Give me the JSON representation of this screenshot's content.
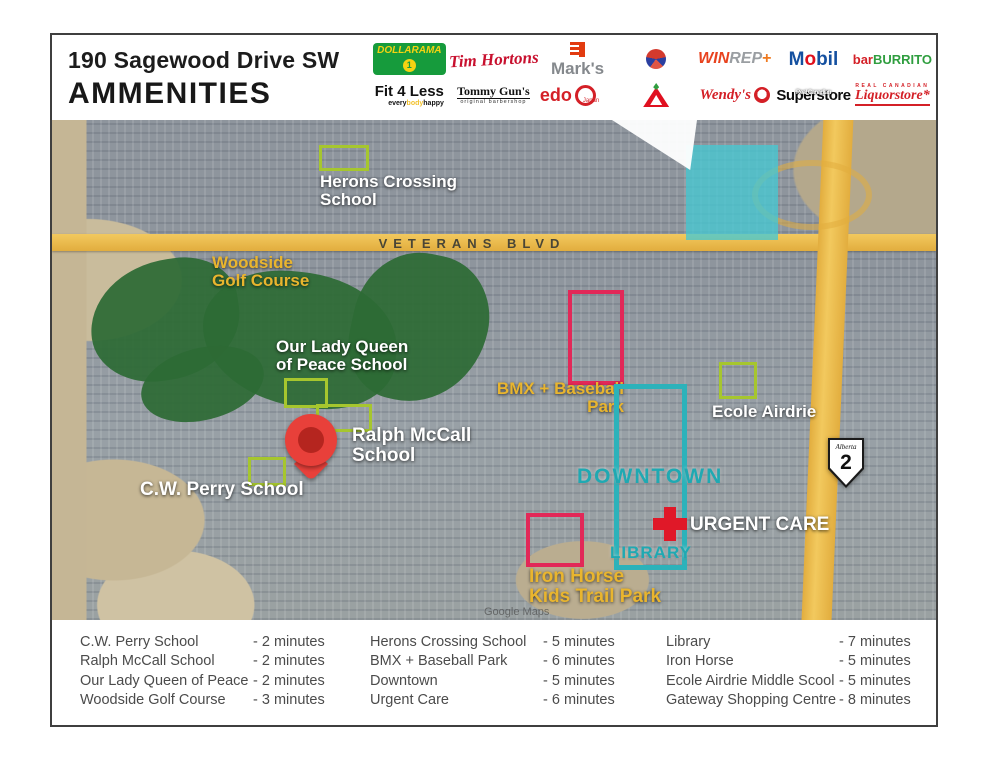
{
  "header": {
    "address": "190 Sagewood Drive SW",
    "title": "AMMENITIES"
  },
  "logos": {
    "dollarama": {
      "text": "DOLLARAMA",
      "coin": "1"
    },
    "tim_hortons": {
      "text": "Tim Hortons"
    },
    "marks": {
      "text": "Mark's"
    },
    "globe": {
      "icon": "red-blue-globe-logo"
    },
    "winrep": {
      "win": "WIN",
      "rep": "REP",
      "plus": "+"
    },
    "mobil": {
      "pre": "M",
      "o": "o",
      "post": "bil"
    },
    "barburrito": {
      "bar": "bar",
      "burrito": "BURRITO"
    },
    "fit4less": {
      "text": "Fit 4 Less",
      "tagline": [
        "every",
        "body",
        "happy"
      ]
    },
    "tommy_guns": {
      "text": "Tommy Gun's",
      "tagline": "original barbershop"
    },
    "edo": {
      "text": "edo",
      "sub": "Japan"
    },
    "canadian_tire": {
      "icon": "canadian-tire-triangle-logo"
    },
    "wendys": {
      "text": "Wendy's"
    },
    "superstore": {
      "overlay": "Real Canadian",
      "text": "Superstore"
    },
    "liquorstore": {
      "overlay": "REAL CANADIAN",
      "text": "Liquorstore*"
    }
  },
  "map": {
    "road_label": "VETERANS BLVD",
    "watermark": "Google Maps",
    "highway_shield": {
      "province": "Alberta",
      "number": "2"
    },
    "labels": {
      "herons": [
        "Herons Crossing",
        "School"
      ],
      "woodside": [
        "Woodside",
        "Golf Course"
      ],
      "our_lady": [
        "Our Lady Queen",
        "of Peace School"
      ],
      "bmx": [
        "BMX + Baseball",
        "Park"
      ],
      "ecole": "Ecole Airdrie",
      "ralph": [
        "Ralph McCall",
        "School"
      ],
      "cw_perry": "C.W. Perry School",
      "downtown": "DOWNTOWN",
      "urgent_care": "URGENT CARE",
      "library": "LIBRARY",
      "iron_horse": [
        "Iron Horse",
        "Kids Trail Park"
      ]
    }
  },
  "legend": {
    "columns": [
      {
        "rows": [
          {
            "name": "C.W. Perry School",
            "time": "- 2 minutes"
          },
          {
            "name": "Ralph McCall School",
            "time": "- 2 minutes"
          },
          {
            "name": "Our Lady Queen of Peace",
            "time": "- 2 minutes"
          },
          {
            "name": "Woodside Golf Course",
            "time": "- 3 minutes"
          }
        ]
      },
      {
        "rows": [
          {
            "name": "Herons Crossing School",
            "time": "- 5 minutes"
          },
          {
            "name": "BMX + Baseball Park",
            "time": "- 6 minutes"
          },
          {
            "name": "Downtown",
            "time": "- 5 minutes"
          },
          {
            "name": "Urgent Care",
            "time": "- 6 minutes"
          }
        ]
      },
      {
        "rows": [
          {
            "name": "Library",
            "time": "- 7 minutes"
          },
          {
            "name": "Iron Horse",
            "time": "- 5 minutes"
          },
          {
            "name": "Ecole Airdrie Middle Scool",
            "time": "- 5 minutes"
          },
          {
            "name": "Gateway Shopping Centre",
            "time": "- 8 minutes"
          }
        ]
      }
    ]
  },
  "colors": {
    "school_outline_green": "#a6c62e",
    "park_outline_pink": "#e22858",
    "downtown_teal": "#2cb2ba",
    "gold_label": "#e9b52e",
    "road_yellow": "#eebb4e",
    "pin_red": "#e8403a",
    "urgent_cross_red": "#e01828",
    "golf_green": "#2d6a35"
  }
}
